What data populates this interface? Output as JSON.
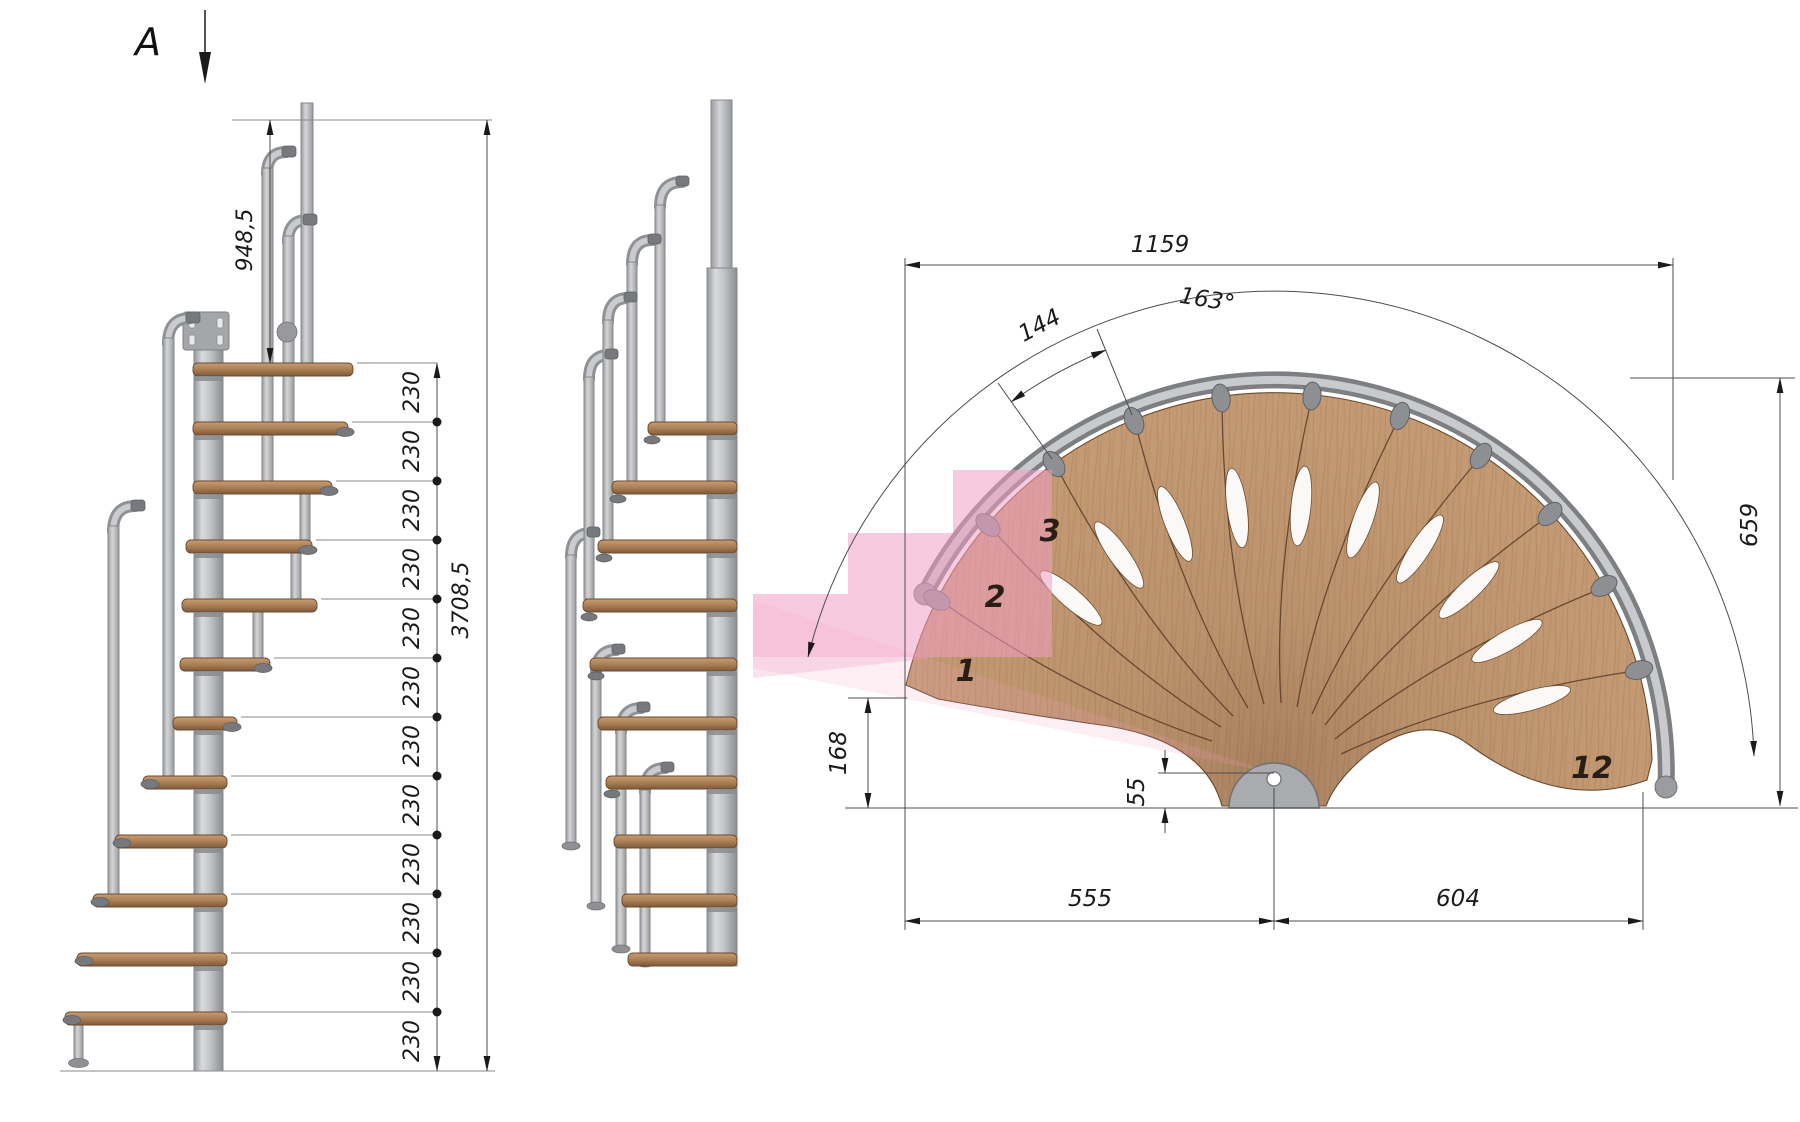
{
  "section_marker": {
    "label": "A"
  },
  "plan_view": {
    "dimensions": {
      "overall_width": "1159",
      "step_arc_width": "144",
      "total_angle": "163°",
      "overall_depth": "659",
      "entry_corner_offset": "168",
      "pole_center_offset": "55",
      "left_span": "555",
      "right_span": "604"
    },
    "step_numbers": {
      "first": "1",
      "second": "2",
      "third": "3",
      "last": "12"
    }
  },
  "elevation_view": {
    "dimensions": {
      "top_rail_height": "948,5",
      "step_rise": "230",
      "total_height": "3708,5"
    },
    "step_rise_count": 12
  },
  "colors": {
    "wood": "#c49b74",
    "wood_line": "#5a3c28",
    "metal": "#b6b8bb",
    "metal_dark": "#85878a",
    "highlight_pink": "#f29ec4",
    "dim_line": "#4d4d4d"
  }
}
